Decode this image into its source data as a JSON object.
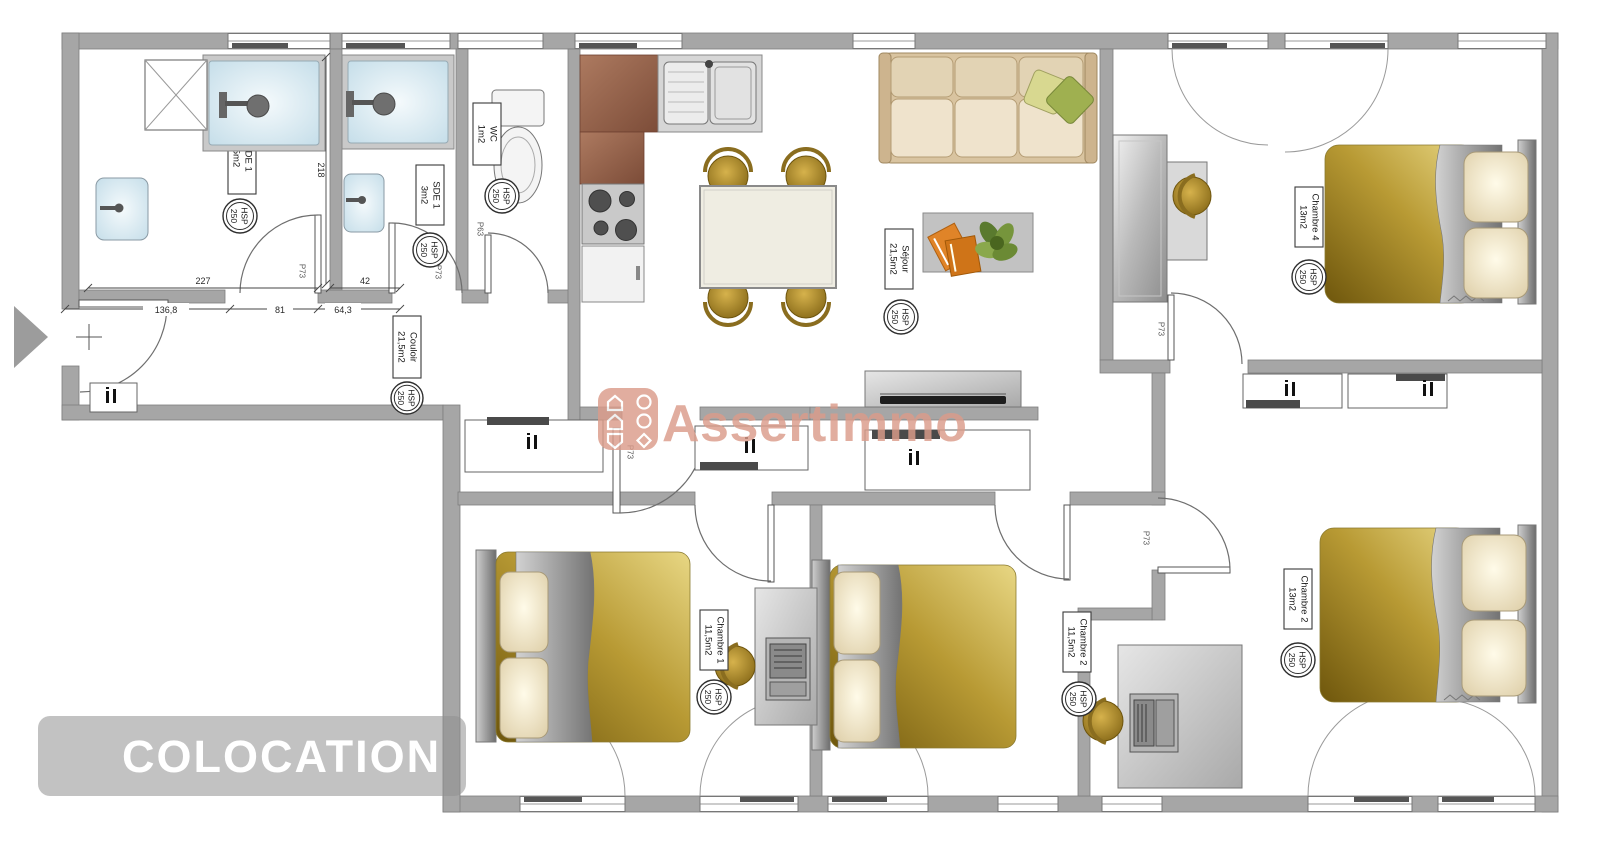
{
  "banner": {
    "label": "COLOCATION"
  },
  "watermark": {
    "brand": "Assertimmo"
  },
  "hsp": {
    "label": "HSP",
    "value": "250"
  },
  "rooms": {
    "bath_left": {
      "name": "SDE 1",
      "area": "5m2"
    },
    "bath_right": {
      "name": "SDE 1",
      "area": "3m2"
    },
    "wc": {
      "name": "WC",
      "area": "1m2"
    },
    "sejour": {
      "name": "Séjour",
      "area": "21,5m2"
    },
    "couloir": {
      "name": "Couloir",
      "area": "21,5m2"
    },
    "bedroom_bottom_left": {
      "name": "Chambre 1",
      "area": "11,5m2"
    },
    "bedroom_bottom_middle": {
      "name": "Chambre 2",
      "area": "11,5m2"
    },
    "bedroom_bottom_right": {
      "name": "Chambre 2",
      "area": "13m2"
    },
    "bedroom_top_right": {
      "name": "Chambre 4",
      "area": "13m2"
    }
  },
  "door_codes": {
    "bath_left": "P73",
    "bath_right": "P73",
    "wc": "P63",
    "sejour": "P73",
    "bedroom_bottom_right": "P73",
    "bedroom_top_right": "P73"
  },
  "dimensions": {
    "corridor_left": "227",
    "corridor_right": "42",
    "lower_left": "136,8",
    "lower_mid": "81",
    "lower_right": "64,3",
    "vertical": "218"
  },
  "colors": {
    "wall": "#a6a6a6",
    "watermark": "#db9c8a",
    "banner_bg": "#c2c2c2",
    "banner_text": "#ffffff",
    "duvet_gold": "#b1861c",
    "shower_blue": "#cfe2ec",
    "counter_brown": "#935f49"
  }
}
